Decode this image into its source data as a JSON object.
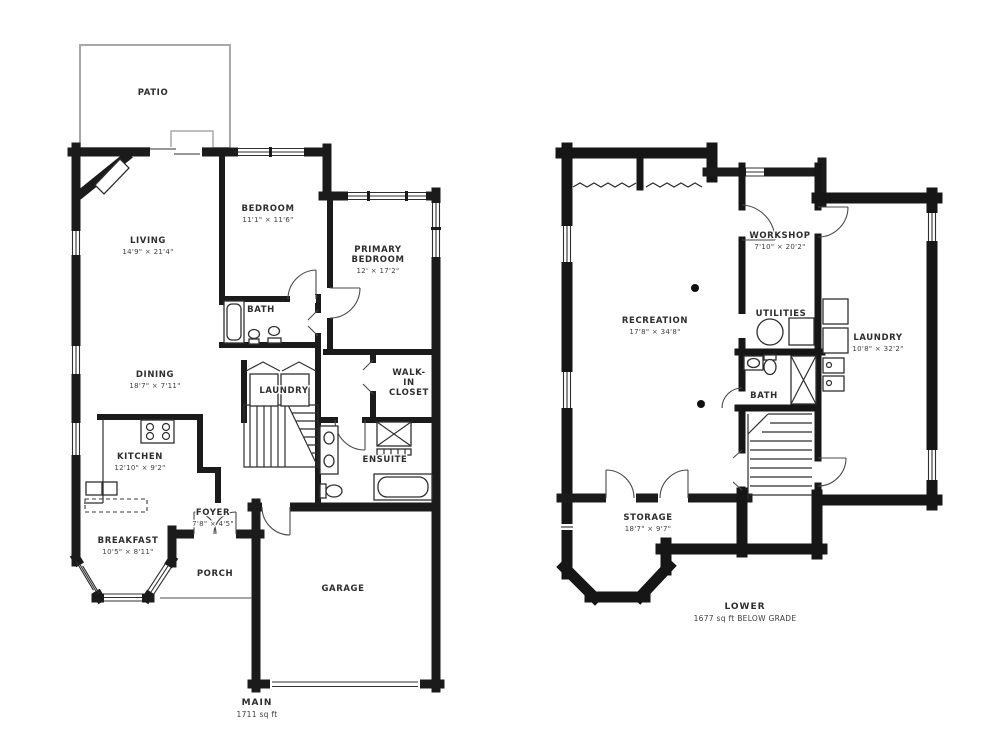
{
  "page": {
    "background": "#ffffff",
    "wall_color": "#1b1b1b"
  },
  "main_floor": {
    "name": "MAIN",
    "area": "1711 sq ft",
    "rooms": {
      "patio": [
        "PATIO"
      ],
      "living": [
        "LIVING",
        "14'9\" × 21'4\""
      ],
      "bedroom": [
        "BEDROOM",
        "11'1\" × 11'6\""
      ],
      "primary_bedroom": [
        "PRIMARY",
        "BEDROOM",
        "12' × 17'2\""
      ],
      "bath": [
        "BATH"
      ],
      "dining": [
        "DINING",
        "18'7\" × 7'11\""
      ],
      "laundry": [
        "LAUNDRY"
      ],
      "walk_in_closet": [
        "WALK-",
        "IN",
        "CLOSET"
      ],
      "kitchen": [
        "KITCHEN",
        "12'10\" × 9'2\""
      ],
      "ensuite": [
        "ENSUITE"
      ],
      "foyer": [
        "FOYER",
        "7'8\" × 4'5\""
      ],
      "breakfast": [
        "BREAKFAST",
        "10'5\" × 8'11\""
      ],
      "porch": [
        "PORCH"
      ],
      "garage": [
        "GARAGE"
      ]
    }
  },
  "lower_floor": {
    "name": "LOWER",
    "area": "1677 sq ft BELOW GRADE",
    "rooms": {
      "recreation": [
        "RECREATION",
        "17'8\" × 34'8\""
      ],
      "workshop": [
        "WORKSHOP",
        "7'10\" × 20'2\""
      ],
      "utilities": [
        "UTILITIES"
      ],
      "laundry": [
        "LAUNDRY",
        "10'8\" × 32'2\""
      ],
      "bath": [
        "BATH"
      ],
      "storage": [
        "STORAGE",
        "18'7\" × 9'7\""
      ]
    }
  }
}
